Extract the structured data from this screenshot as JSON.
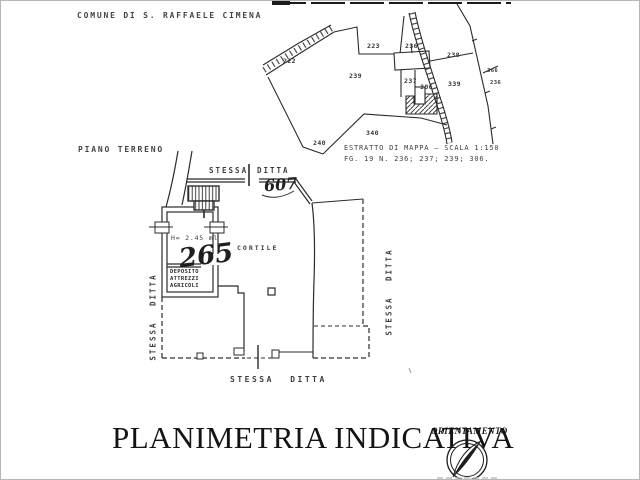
{
  "page": {
    "header": "COMUNE DI S. RAFFAELE CIMENA",
    "title": "PLANIMETRIA INDICATIVA"
  },
  "map_extract": {
    "caption_line1": "ESTRATTO DI MAPPA — SCALA 1:150",
    "caption_line2": "FG. 19 N. 236; 237; 239; 306.",
    "parcels": [
      "222",
      "223",
      "236",
      "238",
      "239",
      "237",
      "306",
      "339",
      "366",
      "236",
      "340",
      "240"
    ]
  },
  "floor_plan": {
    "floor_label": "PIANO TERRENO",
    "boundary_top_word1": "STESSA",
    "boundary_top_word2": "DITTA",
    "handwritten_top": "607",
    "room_height": "H= 2.45 ml",
    "handwritten_room": "265",
    "deposito_line1": "DEPOSITO",
    "deposito_line2": "ATTREZZI",
    "deposito_line3": "AGRICOLI",
    "courtyard_label": "CORTILE",
    "boundary_left": "STESSA DITTA",
    "boundary_right": "STESSA DITTA",
    "boundary_bottom": "STESSA DITTA"
  },
  "compass": {
    "label": "ORIENTAMENTO"
  },
  "colors": {
    "ink": "#2b2b2b",
    "paper": "#ffffff"
  }
}
